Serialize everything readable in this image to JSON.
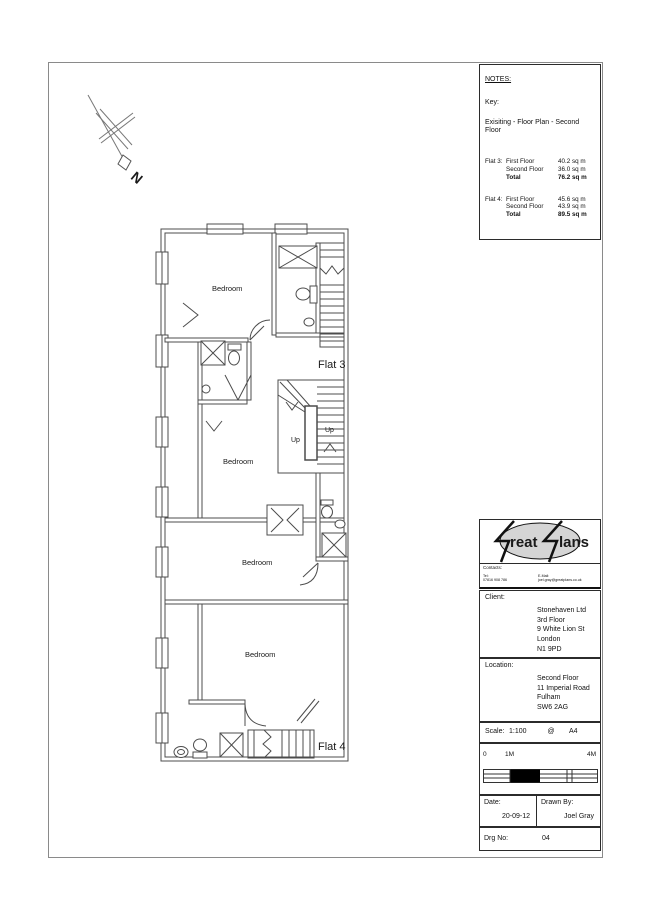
{
  "page": {
    "border_color": "#8a8a8a"
  },
  "north": {
    "label": "N"
  },
  "plan": {
    "bedroom1": "Bedroom",
    "bedroom2": "Bedroom",
    "bedroom3": "Bedroom",
    "bedroom4": "Bedroom",
    "flat3": "Flat 3",
    "flat4": "Flat 4",
    "up1": "Up",
    "up2": "Up"
  },
  "notes": {
    "title": "NOTES:",
    "key": "Key:",
    "subtitle": "Exisiting - Floor Plan - Second Floor",
    "flat3": {
      "name": "Flat 3:",
      "r1l": "First Floor",
      "r1v": "40.2 sq m",
      "r2l": "Second Floor",
      "r2v": "36.0 sq m",
      "r3l": "Total",
      "r3v": "76.2 sq m"
    },
    "flat4": {
      "name": "Flat 4:",
      "r1l": "First Floor",
      "r1v": "45.6 sq m",
      "r2l": "Second Floor",
      "r2v": "43.9 sq m",
      "r3l": "Total",
      "r3v": "89.5 sq m"
    }
  },
  "logo": {
    "part1": "reat",
    "part2": "lans"
  },
  "contacts": {
    "label": "Contacts:",
    "tel_label": "Tel:",
    "tel_value": "07816 908 786",
    "email_label": "E-Mail:",
    "email_value": "joel.gray@greatplans.co.uk"
  },
  "client": {
    "label": "Client:",
    "line1": "Stonehaven Ltd",
    "line2": "3rd Floor",
    "line3": "9 White Lion St",
    "line4": "London",
    "line5": "N1 9PD"
  },
  "location": {
    "label": "Location:",
    "line1": "Second Floor",
    "line2": "11 Imperial Road",
    "line3": "Fulham",
    "line4": "SW6 2AG"
  },
  "scalebox": {
    "label": "Scale:",
    "value": "1:100",
    "at": "@",
    "paper": "A4",
    "tick0": "0",
    "tick1": "1M",
    "tick4": "4M"
  },
  "footer": {
    "date_label": "Date:",
    "date_value": "20-09-12",
    "drawn_label": "Drawn By:",
    "drawn_value": "Joel Gray",
    "drg_label": "Drg No:",
    "drg_value": "04"
  }
}
